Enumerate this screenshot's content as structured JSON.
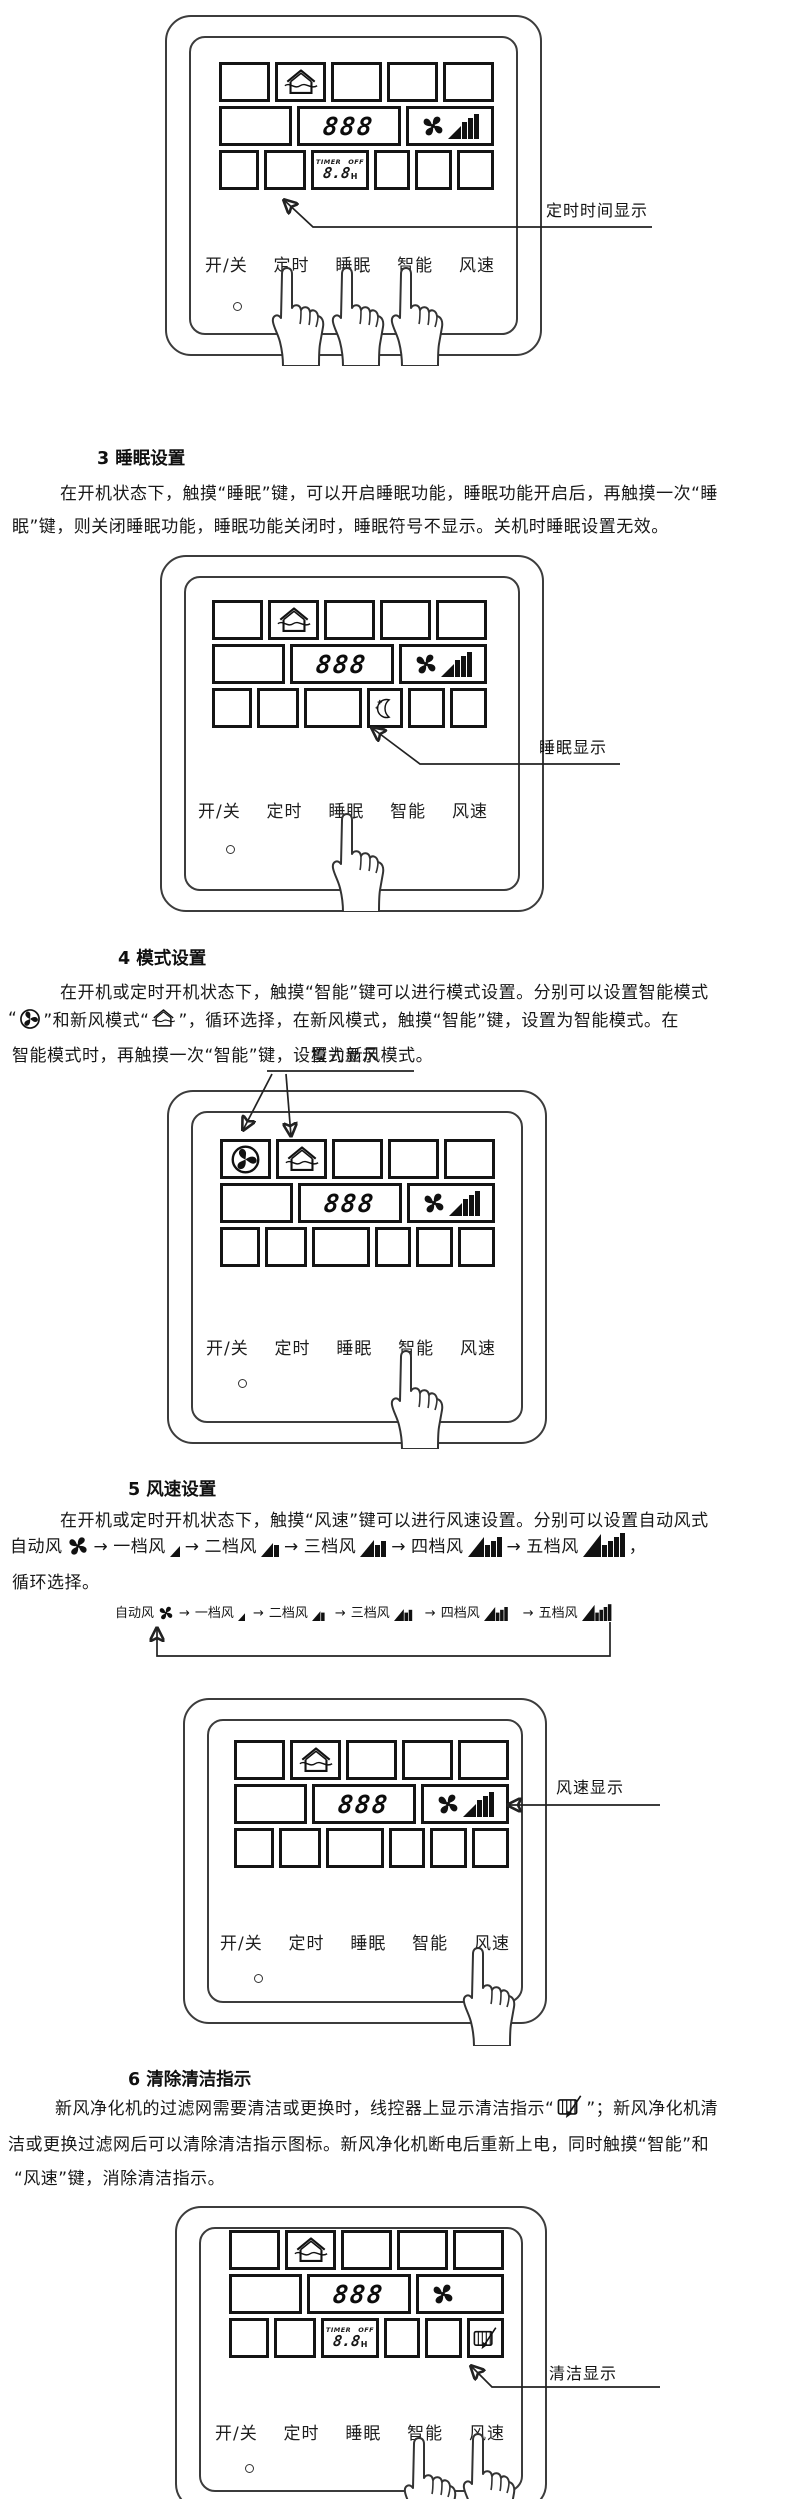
{
  "annotations": {
    "timer_display": "定时时间显示",
    "sleep_display": "睡眠显示",
    "mode_display": "模式显示",
    "fan_display": "风速显示",
    "clean_display": "清洁显示"
  },
  "buttons": {
    "power": "开/关",
    "timer": "定时",
    "sleep": "睡眠",
    "smart": "智能",
    "fan_speed": "风速"
  },
  "lcd": {
    "temp_digits": "888",
    "timer_label": "TIMER",
    "off_label": "OFF",
    "timer_hours": "8.8",
    "hours_unit": "H"
  },
  "fan_sequence": {
    "auto": "自动风",
    "levels": [
      "一档风",
      "二档风",
      "三档风",
      "四档风",
      "五档风"
    ],
    "arrow": "→",
    "comma": "，"
  },
  "sections": {
    "s3": {
      "heading": "3 睡眠设置",
      "line1": "在开机状态下，触摸“睡眠”键，可以开启睡眠功能，睡眠功能开启后，再触摸一次“睡",
      "line2": "眠”键，则关闭睡眠功能，睡眠功能关闭时，睡眠符号不显示。关机时睡眠设置无效。"
    },
    "s4": {
      "heading": "4 模式设置",
      "line1": "在开机或定时开机状态下，触摸“智能”键可以进行模式设置。分别可以设置智能模式",
      "line2a": "“",
      "line2b": "”和新风模式“",
      "line2c": "”，循环选择，在新风模式，触摸“智能”键，设置为智能模式。在",
      "line3": "智能模式时，再触摸一次“智能”键，设置为新风模式。"
    },
    "s5": {
      "heading": "5 风速设置",
      "line1": "在开机或定时开机状态下，触摸“风速”键可以进行风速设置。分别可以设置自动风式",
      "line3": "循环选择。"
    },
    "s6": {
      "heading": "6 清除清洁指示",
      "line1a": "新风净化机的过滤网需要清洁或更换时，线控器上显示清洁指示“",
      "line1b": "”；新风净化机清",
      "line2": "洁或更换过滤网后可以清除清洁指示图标。新风净化机断电后重新上电，同时触摸“智能”和",
      "line3": "“风速”键，消除清洁指示。"
    }
  }
}
